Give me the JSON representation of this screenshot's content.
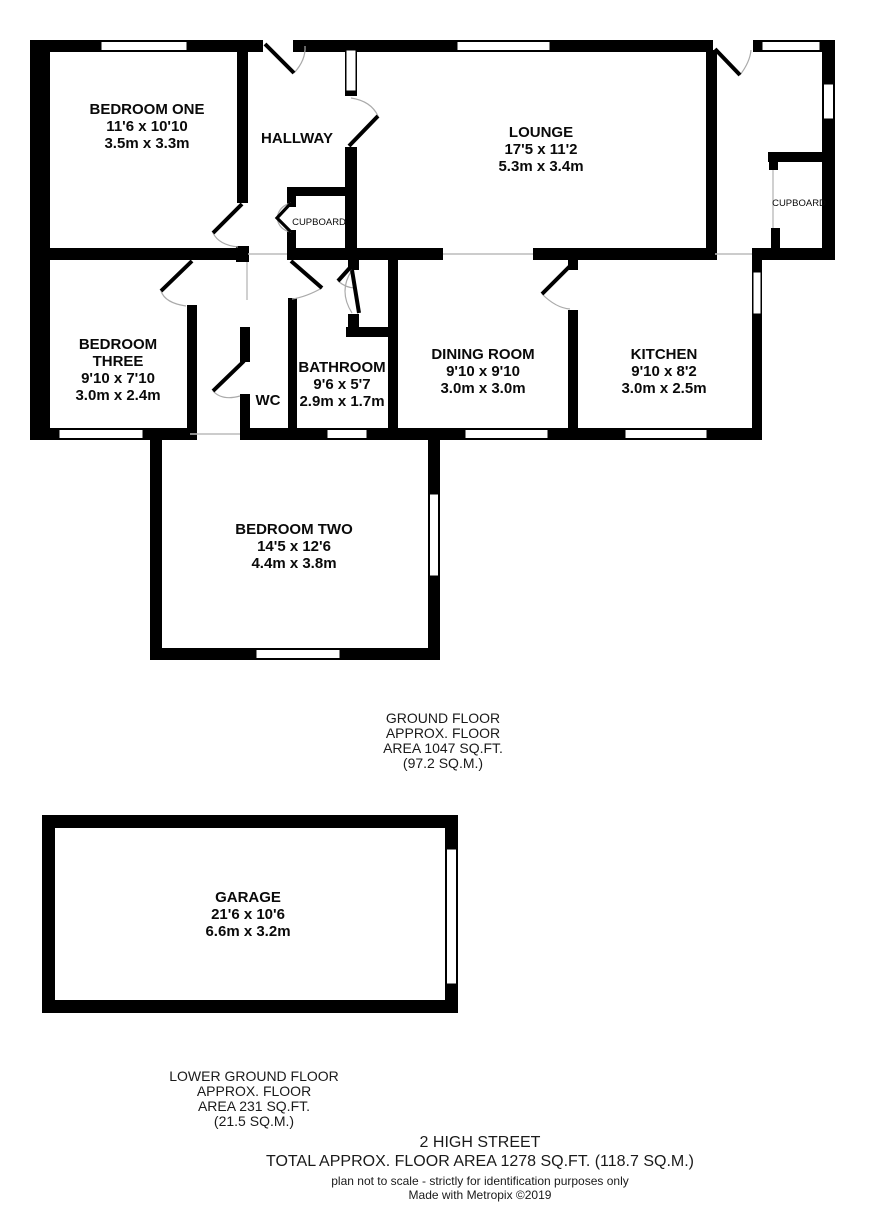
{
  "colors": {
    "wall": "#000000",
    "background": "#ffffff",
    "opening_line": "#bbbbbb",
    "door_arc": "#aaaaaa"
  },
  "rooms": {
    "bedroom_one": {
      "name": "BEDROOM ONE",
      "imperial": "11'6 x 10'10",
      "metric": "3.5m x 3.3m"
    },
    "hallway": {
      "name": "HALLWAY"
    },
    "lounge": {
      "name": "LOUNGE",
      "imperial": "17'5 x 11'2",
      "metric": "5.3m x 3.4m"
    },
    "cupboard_hall": {
      "name": "CUPBOARD"
    },
    "cupboard_rear": {
      "name": "CUPBOARD"
    },
    "bedroom_three": {
      "name_line1": "BEDROOM",
      "name_line2": "THREE",
      "imperial": "9'10 x 7'10",
      "metric": "3.0m x 2.4m"
    },
    "wc": {
      "name": "WC"
    },
    "bathroom": {
      "name": "BATHROOM",
      "imperial": "9'6 x 5'7",
      "metric": "2.9m x 1.7m"
    },
    "dining_room": {
      "name": "DINING ROOM",
      "imperial": "9'10 x 9'10",
      "metric": "3.0m x 3.0m"
    },
    "kitchen": {
      "name": "KITCHEN",
      "imperial": "9'10 x 8'2",
      "metric": "3.0m x 2.5m"
    },
    "bedroom_two": {
      "name": "BEDROOM TWO",
      "imperial": "14'5 x 12'6",
      "metric": "4.4m x 3.8m"
    },
    "garage": {
      "name": "GARAGE",
      "imperial": "21'6 x 10'6",
      "metric": "6.6m x 3.2m"
    }
  },
  "summaries": {
    "ground_floor": {
      "l1": "GROUND FLOOR",
      "l2": "APPROX. FLOOR",
      "l3": "AREA 1047 SQ.FT.",
      "l4": "(97.2 SQ.M.)"
    },
    "lower_ground_floor": {
      "l1": "LOWER GROUND FLOOR",
      "l2": "APPROX. FLOOR",
      "l3": "AREA 231 SQ.FT.",
      "l4": "(21.5 SQ.M.)"
    }
  },
  "footer": {
    "address": "2 HIGH STREET",
    "total_area": "TOTAL APPROX. FLOOR AREA 1278 SQ.FT. (118.7 SQ.M.)",
    "disclaimer": "plan not to scale - strictly for identification purposes only",
    "credit": "Made with Metropix ©2019"
  }
}
